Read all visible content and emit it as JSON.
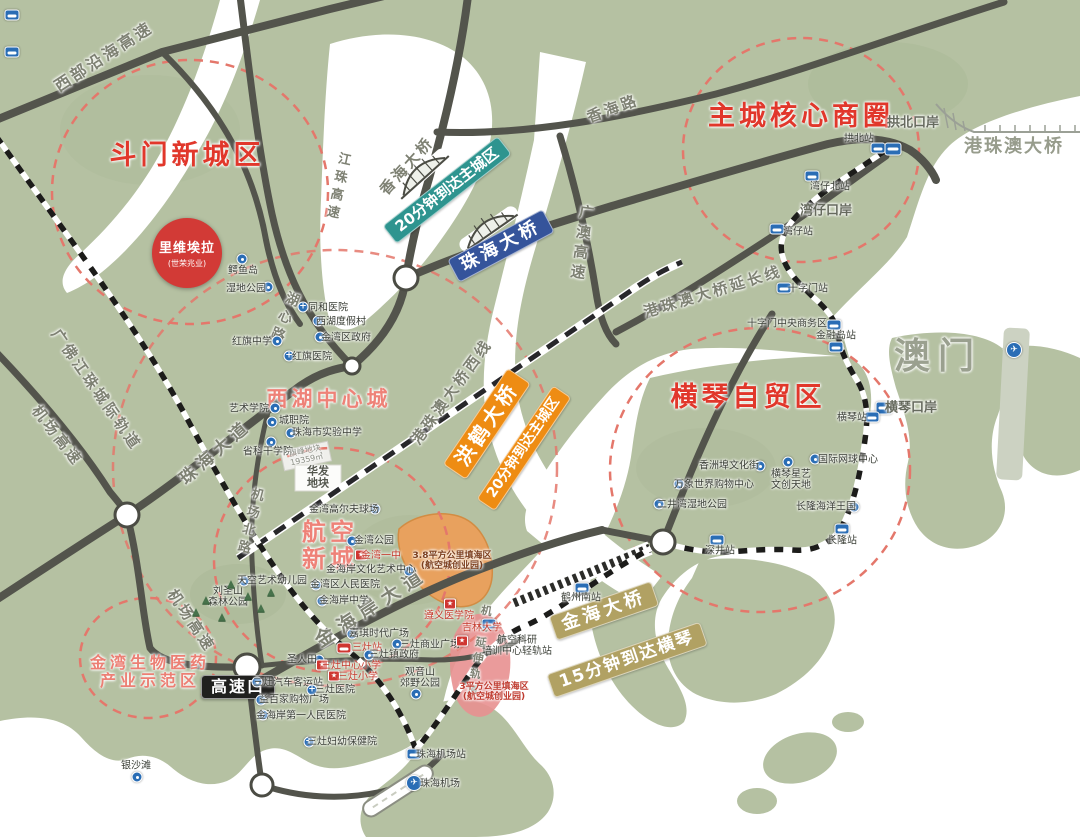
{
  "regions": [
    {
      "label": "斗门新城区",
      "x": 187,
      "y": 156,
      "size": 27,
      "color": "#e1372b"
    },
    {
      "label": "主城核心商圈",
      "x": 801,
      "y": 117,
      "size": 27,
      "color": "#e1372b"
    },
    {
      "label": "横琴自贸区",
      "x": 748,
      "y": 398,
      "size": 27,
      "color": "#e1372b"
    },
    {
      "label": "西湖中心城",
      "x": 329,
      "y": 400,
      "size": 21,
      "color": "#ee8278"
    },
    {
      "lines": [
        "航空",
        "新城"
      ],
      "x": 330,
      "y": 546,
      "size": 24,
      "color": "#ee8278"
    },
    {
      "lines": [
        "金湾生物医药",
        "产业示范区"
      ],
      "x": 150,
      "y": 672,
      "size": 16,
      "color": "#ec7f74"
    }
  ],
  "road_labels": [
    {
      "text": "西部沿海高速",
      "x": 104,
      "y": 57,
      "rotate": -33,
      "size": 16
    },
    {
      "text": "香海路",
      "x": 613,
      "y": 109,
      "rotate": -20,
      "size": 15
    },
    {
      "text": "香海大桥",
      "x": 407,
      "y": 166,
      "rotate": -48,
      "size": 15
    },
    {
      "text": "江珠高速",
      "x": 336,
      "y": 187,
      "rotate": 12,
      "size": 13,
      "vertical": true
    },
    {
      "text": "广澳高速",
      "x": 581,
      "y": 244,
      "rotate": 8,
      "size": 15,
      "vertical": true
    },
    {
      "text": "港珠澳大桥延长线",
      "x": 713,
      "y": 292,
      "rotate": -17,
      "size": 15
    },
    {
      "text": "港珠澳大桥西线",
      "x": 452,
      "y": 392,
      "rotate": -54,
      "size": 15
    },
    {
      "text": "湖心路",
      "x": 283,
      "y": 318,
      "rotate": 22,
      "size": 14,
      "vertical": true
    },
    {
      "text": "广佛江珠城际轨道",
      "x": 96,
      "y": 390,
      "rotate": 55,
      "size": 15
    },
    {
      "text": "机场高速",
      "x": 57,
      "y": 436,
      "rotate": 52,
      "size": 15
    },
    {
      "text": "机场高速",
      "x": 191,
      "y": 621,
      "rotate": 56,
      "size": 15
    },
    {
      "text": "珠海大道",
      "x": 216,
      "y": 453,
      "rotate": -41,
      "size": 17,
      "ls": 5
    },
    {
      "text": "机场北路",
      "x": 248,
      "y": 522,
      "rotate": 14,
      "size": 13,
      "vertical": true
    },
    {
      "text": "金海岸大道",
      "x": 372,
      "y": 608,
      "rotate": -33,
      "size": 19,
      "ls": 7
    },
    {
      "text": "机场延伸轨道",
      "x": 478,
      "y": 652,
      "rotate": 10,
      "size": 11,
      "vertical": true
    }
  ],
  "area_labels": [
    {
      "text": "拱北口岸",
      "x": 913,
      "y": 124,
      "size": 13,
      "color": "#666a5e"
    },
    {
      "text": "湾仔口岸",
      "x": 826,
      "y": 212,
      "size": 13,
      "color": "#666a5e"
    },
    {
      "text": "港珠澳大桥",
      "x": 1014,
      "y": 147,
      "size": 18,
      "color": "#979c8c",
      "ls": 2
    },
    {
      "text": "澳门",
      "x": 938,
      "y": 357,
      "size": 36,
      "color": "#9aa08f",
      "ls": 8
    }
  ],
  "badges": [
    {
      "text": "20分钟到达主城区",
      "x": 447,
      "y": 190,
      "rotate": -38,
      "bg": "#2e948f",
      "size": 15
    },
    {
      "text": "珠海大桥",
      "x": 501,
      "y": 246,
      "rotate": -28,
      "bg": "#35549b",
      "size": 18,
      "ls": 4
    },
    {
      "text": "洪鹤大桥",
      "x": 487,
      "y": 424,
      "rotate": -56,
      "bg": "#ee8c13",
      "size": 20,
      "ls": 4
    },
    {
      "text": "20分钟到达主城区",
      "x": 524,
      "y": 448,
      "rotate": -56,
      "bg": "#ee8c13",
      "size": 14
    },
    {
      "text": "金海大桥",
      "x": 604,
      "y": 611,
      "rotate": -19,
      "bg": "#b1a163",
      "size": 18,
      "ls": 4
    },
    {
      "text": "15分钟到达横琴",
      "x": 627,
      "y": 660,
      "rotate": -19,
      "bg": "#b1a163",
      "size": 17,
      "ls": 2
    },
    {
      "text": "高速口",
      "x": 238,
      "y": 687,
      "rotate": 0,
      "bg": "#20201e",
      "size": 16,
      "ls": 2
    }
  ],
  "landmark": {
    "name": "里维埃拉",
    "subtitle": "(世荣兆业)",
    "x": 187,
    "y": 253
  },
  "stations": [
    {
      "label": "拱北站",
      "lx": 859,
      "ly": 139,
      "ix": 878,
      "iy": 148
    },
    {
      "ix": 893,
      "iy": 149,
      "port": true
    },
    {
      "label": "湾仔北站",
      "lx": 830,
      "ly": 187,
      "ix": 812,
      "iy": 176
    },
    {
      "label": "湾仔站",
      "lx": 798,
      "ly": 232,
      "ix": 777,
      "iy": 229
    },
    {
      "label": "十字门站",
      "lx": 808,
      "ly": 289,
      "ix": 784,
      "iy": 288
    },
    {
      "label": "十字门中央商务区",
      "lx": 787,
      "ly": 324,
      "ix": 834,
      "iy": 325
    },
    {
      "label": "金融岛站",
      "lx": 836,
      "ly": 336,
      "ix": 836,
      "iy": 347
    },
    {
      "label": "横琴口岸",
      "lx": 911,
      "ly": 409,
      "ix": 884,
      "iy": 408,
      "port": true,
      "gray": true
    },
    {
      "label": "横琴站",
      "lx": 852,
      "ly": 418,
      "ix": 872,
      "iy": 417
    },
    {
      "label": "长隆站",
      "lx": 842,
      "ly": 541,
      "ix": 842,
      "iy": 529
    },
    {
      "label": "深井站",
      "lx": 720,
      "ly": 551,
      "ix": 717,
      "iy": 540
    },
    {
      "label": "鹤州南站",
      "lx": 581,
      "ly": 598,
      "ix": 582,
      "iy": 588
    },
    {
      "lines": [
        "航空科研",
        "培训中心轻轨站"
      ],
      "lx": 517,
      "ly": 646,
      "ix": 489,
      "iy": 624
    },
    {
      "label": "珠海机场站",
      "lx": 441,
      "ly": 755,
      "ix": 414,
      "iy": 754
    },
    {
      "label": "三灶站",
      "lx": 367,
      "ly": 648,
      "ix": 344,
      "iy": 648,
      "red": true
    },
    {
      "ix": 12,
      "iy": 15
    },
    {
      "ix": 12,
      "iy": 52
    },
    {
      "label": "珠海机场",
      "lx": 440,
      "ly": 784,
      "ix": 414,
      "iy": 783,
      "air": true
    },
    {
      "ix": 1014,
      "iy": 350,
      "air": true
    }
  ],
  "pois": [
    {
      "label": "鳄鱼岛",
      "lx": 243,
      "ly": 271,
      "ix": 242,
      "iy": 259
    },
    {
      "label": "湿地公园",
      "lx": 246,
      "ly": 289,
      "ix": 268,
      "iy": 287
    },
    {
      "label": "同和医院",
      "lx": 328,
      "ly": 308,
      "ix": 303,
      "iy": 307,
      "t": "hosp"
    },
    {
      "label": "西湖度假村",
      "lx": 341,
      "ly": 322,
      "ix": 318,
      "iy": 321
    },
    {
      "label": "金湾区政府",
      "lx": 346,
      "ly": 338,
      "ix": 320,
      "iy": 337
    },
    {
      "label": "红旗中学",
      "lx": 252,
      "ly": 342,
      "ix": 277,
      "iy": 341
    },
    {
      "label": "红旗医院",
      "lx": 312,
      "ly": 357,
      "ix": 289,
      "iy": 356,
      "t": "hosp"
    },
    {
      "label": "艺术学院",
      "lx": 249,
      "ly": 409,
      "ix": 275,
      "iy": 408
    },
    {
      "label": "城职院",
      "lx": 294,
      "ly": 421,
      "ix": 272,
      "iy": 422
    },
    {
      "label": "珠海市实验中学",
      "lx": 327,
      "ly": 433,
      "ix": 291,
      "iy": 433
    },
    {
      "label": "省科干学院",
      "lx": 268,
      "ly": 452,
      "ix": 271,
      "iy": 442
    },
    {
      "label": "金湾高尔夫球场",
      "lx": 344,
      "ly": 510,
      "ix": 375,
      "iy": 509
    },
    {
      "label": "金湾公园",
      "lx": 374,
      "ly": 541,
      "ix": 352,
      "iy": 541
    },
    {
      "label": "金湾一中",
      "lx": 381,
      "ly": 556,
      "ix": 361,
      "iy": 555,
      "t": "school",
      "red": true
    },
    {
      "label": "金海岸文化艺术中心",
      "lx": 371,
      "ly": 570,
      "ix": 409,
      "iy": 571
    },
    {
      "label": "金湾区人民医院",
      "lx": 345,
      "ly": 585,
      "ix": 316,
      "iy": 585,
      "t": "hosp"
    },
    {
      "label": "金海岸中学",
      "lx": 344,
      "ly": 601,
      "ix": 322,
      "iy": 601
    },
    {
      "label": "天空艺术幼儿园",
      "lx": 272,
      "ly": 581,
      "ix": 244,
      "iy": 581
    },
    {
      "lines": [
        "刘圣山",
        "森林公园"
      ],
      "lx": 228,
      "ly": 597
    },
    {
      "label": "嘉琪时代广场",
      "lx": 379,
      "ly": 634,
      "ix": 352,
      "iy": 634
    },
    {
      "label": "三灶商业广场",
      "lx": 430,
      "ly": 645,
      "ix": 397,
      "iy": 644
    },
    {
      "label": "三灶镇政府",
      "lx": 394,
      "ly": 655,
      "ix": 369,
      "iy": 655
    },
    {
      "label": "圣人田",
      "lx": 302,
      "ly": 660,
      "ix": 319,
      "iy": 660
    },
    {
      "label": "三灶中心小学",
      "lx": 351,
      "ly": 666,
      "ix": 322,
      "iy": 665,
      "t": "school",
      "red": true
    },
    {
      "label": "三灶小学",
      "lx": 358,
      "ly": 677,
      "ix": 334,
      "iy": 676,
      "t": "school",
      "red": true
    },
    {
      "label": "三灶汽车客运站",
      "lx": 288,
      "ly": 683,
      "ix": 257,
      "iy": 682
    },
    {
      "label": "三灶医院",
      "lx": 335,
      "ly": 690,
      "ix": 312,
      "iy": 690,
      "t": "hosp"
    },
    {
      "label": "益百家购物广场",
      "lx": 294,
      "ly": 700,
      "ix": 261,
      "iy": 700
    },
    {
      "label": "金海岸第一人民医院",
      "lx": 301,
      "ly": 716,
      "ix": 263,
      "iy": 715,
      "t": "hosp"
    },
    {
      "label": "三灶妇幼保健院",
      "lx": 342,
      "ly": 742,
      "ix": 309,
      "iy": 742,
      "t": "hosp"
    },
    {
      "label": "银沙滩",
      "lx": 136,
      "ly": 766,
      "ix": 137,
      "iy": 777
    },
    {
      "lines": [
        "观音山",
        "郊野公园"
      ],
      "lx": 420,
      "ly": 678,
      "ix": 416,
      "iy": 694
    },
    {
      "label": "遵义医学院",
      "lx": 449,
      "ly": 616,
      "ix": 450,
      "iy": 604,
      "t": "school",
      "red": true
    },
    {
      "label": "吉林大学",
      "lx": 482,
      "ly": 628,
      "ix": 462,
      "iy": 641,
      "t": "school",
      "red": true
    },
    {
      "label": "香洲埠文化街",
      "lx": 729,
      "ly": 466,
      "ix": 760,
      "iy": 466
    },
    {
      "lines": [
        "横琴星艺",
        "文创天地"
      ],
      "lx": 791,
      "ly": 480,
      "ix": 788,
      "iy": 462
    },
    {
      "label": "国际网球中心",
      "lx": 848,
      "ly": 460,
      "ix": 815,
      "iy": 459
    },
    {
      "label": "万象世界购物中心",
      "lx": 714,
      "ly": 485,
      "ix": 679,
      "iy": 484
    },
    {
      "label": "二井湾湿地公园",
      "lx": 692,
      "ly": 505,
      "ix": 659,
      "iy": 504
    },
    {
      "label": "长隆海洋王国",
      "lx": 826,
      "ly": 507,
      "ix": 854,
      "iy": 507
    }
  ],
  "fill_labels": [
    {
      "lines": [
        "3.8平方公里填海区",
        "(航空城创业园)"
      ],
      "x": 452,
      "y": 561,
      "size": 9,
      "color": "#7c3f1e"
    },
    {
      "lines": [
        "3平方公里填海区",
        "(航空城创业园)"
      ],
      "x": 494,
      "y": 692,
      "size": 9,
      "color": "#bf3a2e"
    }
  ],
  "parcel_labels": [
    {
      "lines": [
        "旗峰地块",
        "19359㎡"
      ],
      "x": 306,
      "y": 456,
      "size": 8,
      "color": "#8b8e85",
      "rotate": -12
    },
    {
      "lines": [
        "华发",
        "地块"
      ],
      "x": 318,
      "y": 478,
      "size": 11,
      "color": "#54574e",
      "bold": true,
      "rotate": 0
    }
  ],
  "trees": [
    [
      231,
      584
    ],
    [
      248,
      596
    ],
    [
      206,
      600
    ],
    [
      261,
      608
    ],
    [
      196,
      612
    ],
    [
      222,
      617
    ],
    [
      271,
      592
    ]
  ]
}
